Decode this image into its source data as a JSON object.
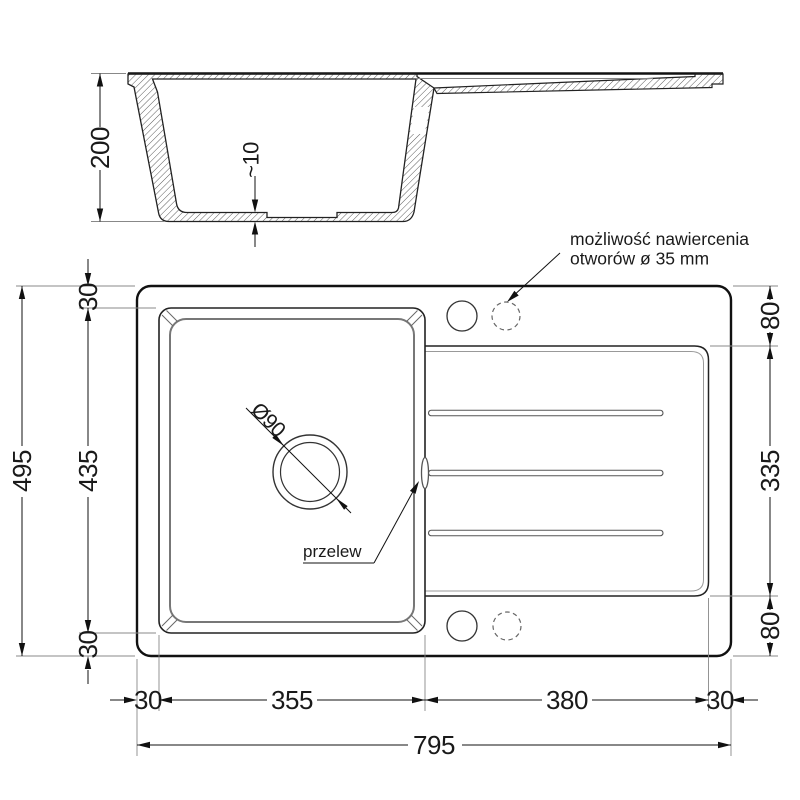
{
  "section": {
    "depth": "200",
    "bottom_step": "~10"
  },
  "plan": {
    "left_axis": {
      "margin_top": "30",
      "bowl": "435",
      "margin_bottom": "30",
      "overall": "495"
    },
    "right_axis": {
      "top": "80",
      "middle": "335",
      "bottom": "80"
    },
    "bottom_axis": {
      "margin_left": "30",
      "bowl": "355",
      "drainer": "380",
      "margin_right": "30",
      "overall": "795"
    },
    "drain_diameter": "Ø90",
    "overflow_label": "przelew",
    "note_line1": "możliwość nawiercenia",
    "note_line2": "otworów ø 35 mm"
  },
  "colors": {
    "ink": "#1a1a1a",
    "medium": "#555555",
    "light": "#888888",
    "background": "#ffffff"
  }
}
